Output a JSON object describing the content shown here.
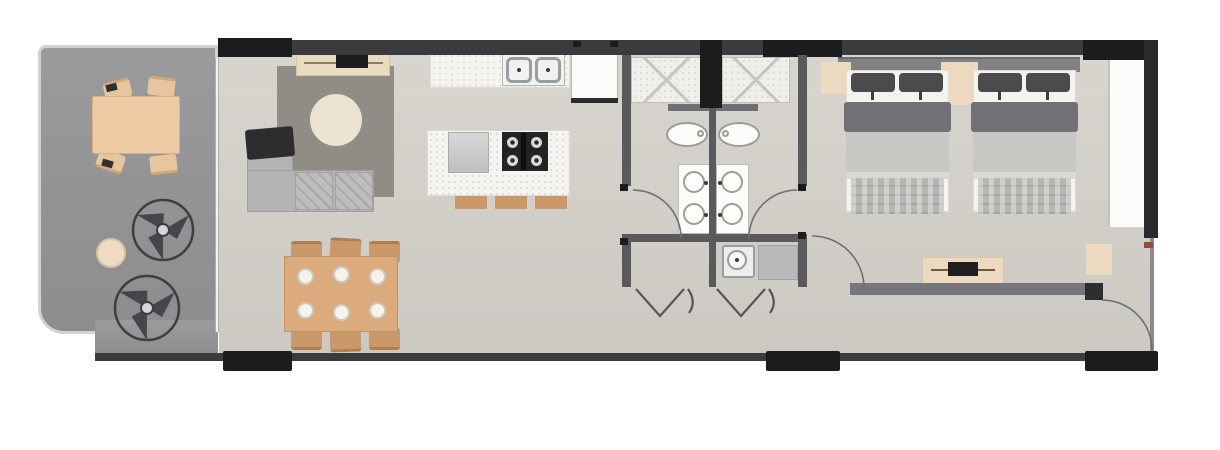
{
  "palette": {
    "background": "#ffffff",
    "floor-main": "#d7d5ce",
    "floor-main-deep": "#cbc9c2",
    "floor-balcony": "#9b9a9c",
    "floor-balcony-deep": "#8d8d8f",
    "railing": "#d2d2d2",
    "wall-dark": "#3b3b3d",
    "wall-black": "#1c1c1e",
    "wall-gray": "#5a5a5d",
    "wall-mid": "#77777b",
    "rug": "#8f8d85",
    "cream": "#ebe2d1",
    "tan-light": "#ecd9c0",
    "wood": "#dcab7d",
    "wood-dark": "#c9996a",
    "wood-edge": "#b07f4f",
    "sofa": "#b4b4b4",
    "sofa-light": "#bdbdbd",
    "throw-dark": "#2d2d30",
    "counter": "#f5f4f0",
    "counter-dot": "#d8d6cf",
    "steel": "#f1f2f2",
    "steel-border": "#9b9c9e",
    "cooktop": "#232325",
    "burner": "#d9d9d7",
    "basin": "#c9c9c9",
    "fridge": "#fbfbfa",
    "tile": "#f0efec",
    "tile-line": "#c6c6c2",
    "fixture-border": "#9c9c96",
    "porcelain": "#fcfcfa",
    "headboard": "#828285",
    "pillow": "#4b4b4e",
    "blanket-dark": "#717175",
    "blanket": "#c6c8c3",
    "sheet": "#f4f3ef",
    "throw-foot": "#b5b7b2",
    "wardrobe": "#fbfbf9",
    "appliance": "#ededee",
    "laundry-counter": "#b9babb",
    "arc": "#6f6f72",
    "fan": "#3e3e41",
    "hinge-brown": "#8a4f3d"
  },
  "floor_plan": {
    "rooms": [
      {
        "id": "balcony",
        "features": [
          "outdoor dining table",
          "4 outdoor chairs",
          "planter pot",
          "2 ceiling-fan symbols",
          "glass railing"
        ]
      },
      {
        "id": "living-room",
        "features": [
          "l-shaped sofa",
          "dark throw blanket",
          "area rug",
          "round ottoman",
          "tv console with tv"
        ]
      },
      {
        "id": "dining-area",
        "features": [
          "rectangular wood table",
          "6 chairs",
          "6 place settings"
        ]
      },
      {
        "id": "kitchen",
        "features": [
          "wall counter",
          "double sink",
          "refrigerator",
          "island with basin",
          "4-burner cooktop",
          "3 bar stools"
        ]
      },
      {
        "id": "bathroom-left",
        "features": [
          "shower",
          "toilet",
          "double-basin vanity",
          "swing door"
        ]
      },
      {
        "id": "bathroom-right",
        "features": [
          "shower",
          "toilet",
          "double-basin vanity",
          "swing door"
        ]
      },
      {
        "id": "laundry-closet",
        "features": [
          "washing machine",
          "counter",
          "bifold doors"
        ]
      },
      {
        "id": "bedroom",
        "features": [
          "two double beds",
          "headboard panel",
          "two nightstands",
          "wardrobe",
          "dresser with tv",
          "bench",
          "swing door"
        ]
      },
      {
        "id": "hallway",
        "features": [
          "entry swing door"
        ]
      }
    ]
  }
}
